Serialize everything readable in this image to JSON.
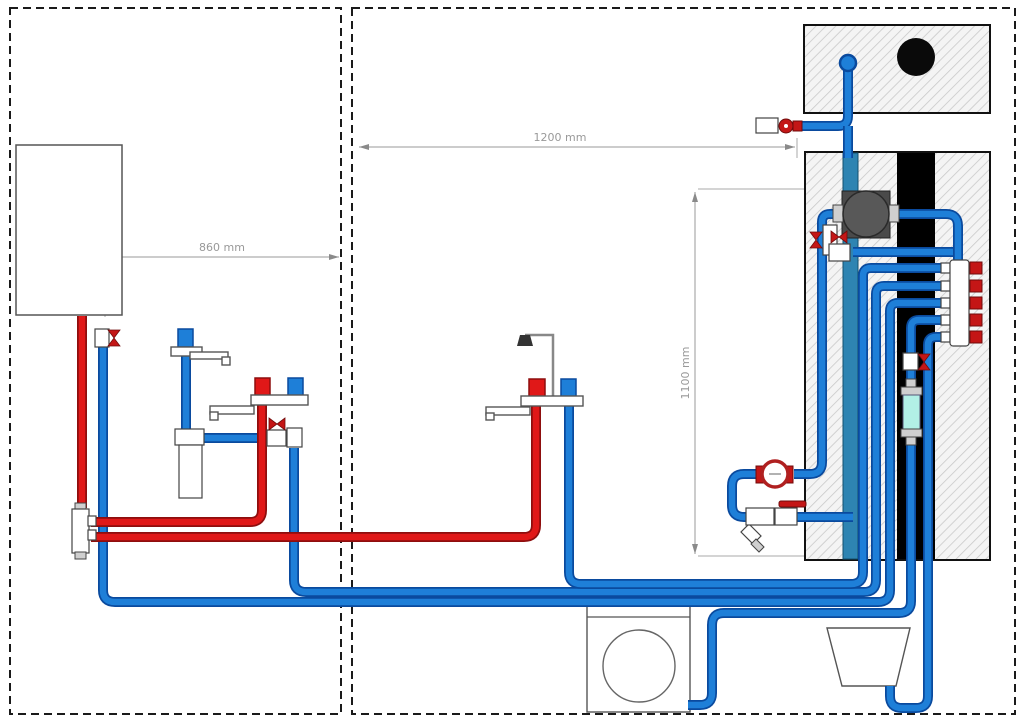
{
  "diagram": {
    "type": "plumbing-installation-scheme",
    "rooms": [
      {
        "name": "left-room",
        "contents": [
          "boiler",
          "cold-tap-with-filter",
          "sink-mixer",
          "hot-water-distributor"
        ]
      },
      {
        "name": "right-room",
        "contents": [
          "bath-shower-mixer",
          "washing-machine",
          "wall-chase",
          "toilet-cistern",
          "pump",
          "manifold",
          "water-meter",
          "strainer",
          "washer-filter",
          "bucket"
        ]
      }
    ],
    "dimensions": {
      "boiler_to_wall": "860 mm",
      "wall_width": "1200 mm",
      "wall_height": "1100 mm"
    },
    "palette": {
      "cold_pipe": "#1e7fd8",
      "cold_pipe_outline": "#0a4a9e",
      "hot_pipe": "#e01818",
      "hot_pipe_outline": "#8e0e0e",
      "riser_pipe": "#2e84b2",
      "valve_red": "#c41616",
      "filter_body": "#b2f0e6",
      "soil_stack": "#000000",
      "pump_body": "#585858",
      "dimension_grey": "#999999",
      "wall_hatch": "#d9d9d9"
    },
    "icons": [
      "valve-bowtie-icon",
      "ball-valve-lever-icon",
      "water-meter-icon",
      "strainer-icon",
      "pump-icon",
      "shower-head-icon",
      "manifold-icon"
    ]
  }
}
